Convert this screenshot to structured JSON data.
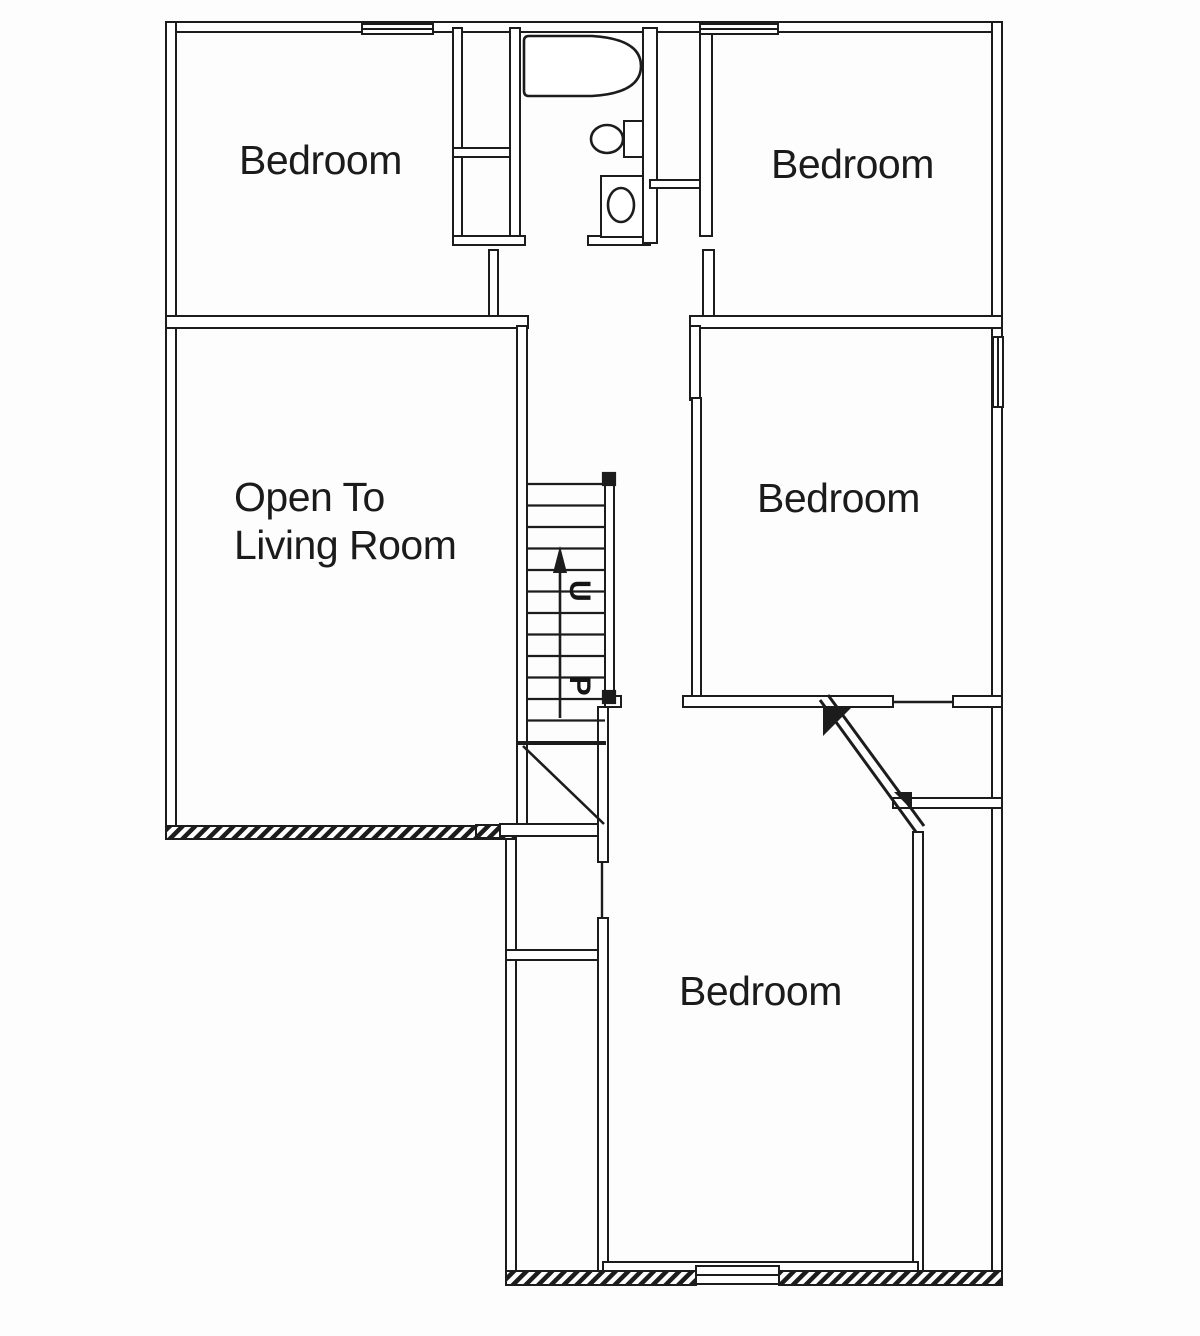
{
  "page": {
    "background_color": "#fdfdfd",
    "ink_color": "#1c1c1c"
  },
  "floor_plan": {
    "labels": {
      "bedroom_top_left": "Bedroom",
      "bedroom_top_right": "Bedroom",
      "bedroom_middle_right": "Bedroom",
      "bedroom_bottom": "Bedroom",
      "open_living_line1": "Open To",
      "open_living_line2": "Living Room",
      "stairs_direction": "UP"
    },
    "fixtures": [
      {
        "name": "bathtub"
      },
      {
        "name": "sink"
      },
      {
        "name": "toilet"
      }
    ],
    "symbols": [
      {
        "name": "stairs-up-arrow"
      },
      {
        "name": "window-symbol"
      },
      {
        "name": "hatched-exterior-wall"
      },
      {
        "name": "chamfered-corner-door"
      }
    ]
  }
}
